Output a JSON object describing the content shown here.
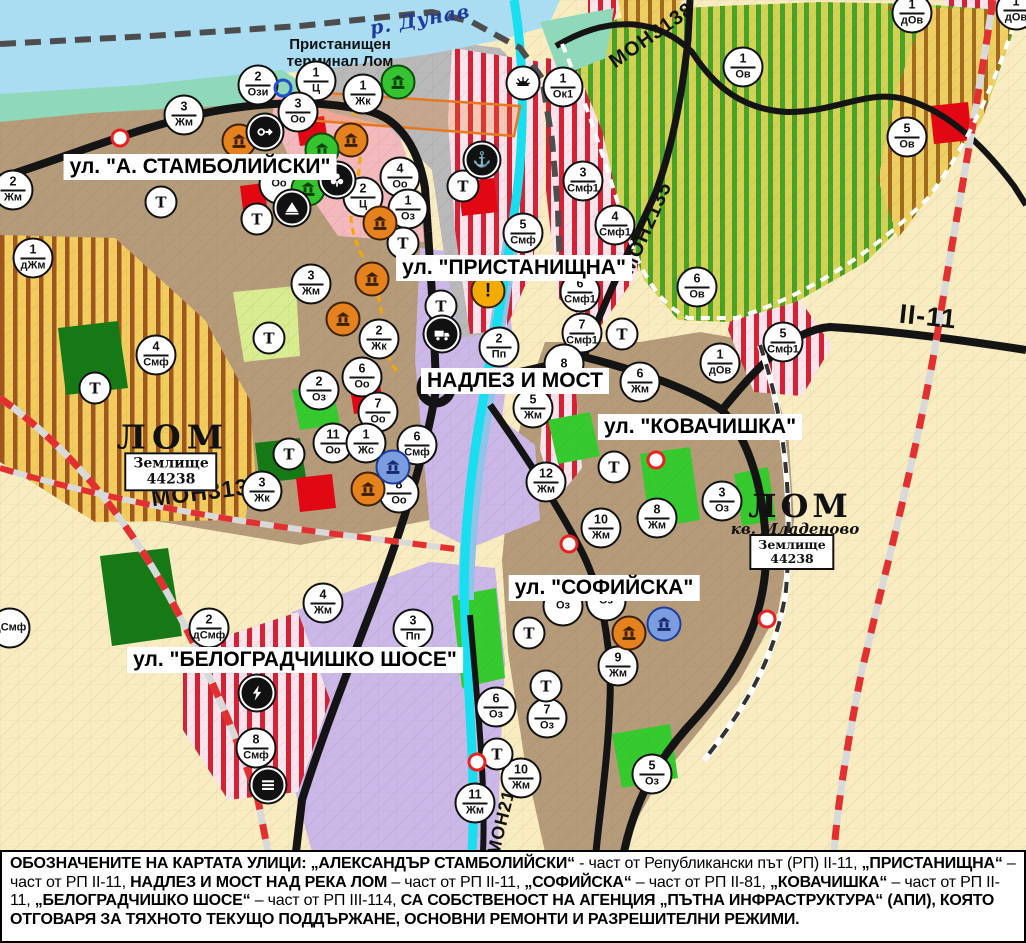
{
  "palette": {
    "water_blue": "#aadcf2",
    "channel_cyan": "#18dff0",
    "river_blue": "#8fc3e8",
    "road_black": "#141414",
    "boundary_red": "#e23030",
    "residential_brown": "#b59b79",
    "industrial_purple": "#cbb8e8",
    "mixed_pink": "#f3b9bd",
    "stripe_red": "#d62135",
    "orchard_green": "#4aa227",
    "farmland_cream": "#f8ecc0",
    "park_green": "#35cb2e",
    "monument_orange": "#e5821e",
    "monument_green": "#35c42f",
    "monument_blue": "#7c9ce0"
  },
  "labels": {
    "river": "р. Дунав",
    "port_line1": "Пристанищен",
    "port_line2": "терминал Лом",
    "city_left": "ЛОМ",
    "city_right": "ЛОМ",
    "district": "кв. Младеново",
    "landzone_line1": "Землище",
    "landzone_number": "44238"
  },
  "street_labels": [
    {
      "text": "ул. \"А. СТАМБОЛИЙСКИ\"",
      "x": 200,
      "y": 167
    },
    {
      "text": "ул. \"ПРИСТАНИЩНА\"",
      "x": 514,
      "y": 268
    },
    {
      "text": "НАДЛЕЗ И МОСТ",
      "x": 515,
      "y": 381
    },
    {
      "text": "ул. \"КОВАЧИШКА\"",
      "x": 700,
      "y": 427
    },
    {
      "text": "ул. \"СОФИЙСКА\"",
      "x": 604,
      "y": 588
    },
    {
      "text": "ул. \"БЕЛОГРАДЧИШКО ШОСЕ\"",
      "x": 295,
      "y": 660
    }
  ],
  "road_labels": [
    {
      "text": "МОН3138",
      "x": 652,
      "y": 36,
      "rot": -35,
      "size": 20
    },
    {
      "text": "МОН2135",
      "x": 647,
      "y": 228,
      "rot": -66,
      "size": 20
    },
    {
      "text": "МОН3139",
      "x": 207,
      "y": 492,
      "rot": -7,
      "size": 23
    },
    {
      "text": "МОН2136",
      "x": 504,
      "y": 812,
      "rot": -76,
      "size": 18
    },
    {
      "text": "II-11",
      "x": 928,
      "y": 317,
      "rot": 6,
      "size": 27
    }
  ],
  "markers": {
    "transport_label": "Т",
    "zone": [
      [
        258,
        85,
        "2",
        "Ози"
      ],
      [
        316,
        81,
        "1",
        "Ц"
      ],
      [
        298,
        112,
        "3",
        "Оо"
      ],
      [
        363,
        94,
        "1",
        "Жк"
      ],
      [
        184,
        115,
        "3",
        "Жм"
      ],
      [
        13,
        190,
        "2",
        "Жм"
      ],
      [
        33,
        258,
        "1",
        "дЖм"
      ],
      [
        279,
        184,
        "",
        "Оо"
      ],
      [
        400,
        177,
        "4",
        "Оо"
      ],
      [
        363,
        197,
        "2",
        "Ц"
      ],
      [
        408,
        209,
        "1",
        "Оз"
      ],
      [
        311,
        284,
        "3",
        "Жм"
      ],
      [
        379,
        339,
        "2",
        "Жк"
      ],
      [
        362,
        377,
        "6",
        "Оо"
      ],
      [
        319,
        390,
        "2",
        "Оз"
      ],
      [
        378,
        412,
        "7",
        "Оо"
      ],
      [
        333,
        443,
        "11",
        "Оо"
      ],
      [
        366,
        443,
        "1",
        "Жс"
      ],
      [
        417,
        445,
        "6",
        "Смф"
      ],
      [
        399,
        493,
        "8",
        "Оо"
      ],
      [
        262,
        491,
        "3",
        "Жк"
      ],
      [
        156,
        355,
        "4",
        "Смф"
      ],
      [
        523,
        233,
        "5",
        "Смф"
      ],
      [
        563,
        87,
        "1",
        "Ок1"
      ],
      [
        583,
        181,
        "3",
        "Смф1"
      ],
      [
        615,
        225,
        "4",
        "Смф1"
      ],
      [
        580,
        292,
        "6",
        "Смф1"
      ],
      [
        582,
        333,
        "7",
        "Смф1"
      ],
      [
        499,
        347,
        "2",
        "Пп"
      ],
      [
        564,
        364,
        "8",
        ""
      ],
      [
        533,
        408,
        "5",
        "Жм"
      ],
      [
        640,
        382,
        "6",
        "Жм"
      ],
      [
        697,
        287,
        "6",
        "Ов"
      ],
      [
        720,
        363,
        "1",
        "дОв"
      ],
      [
        783,
        342,
        "5",
        "Смф1"
      ],
      [
        743,
        67,
        "1",
        "Ов"
      ],
      [
        907,
        137,
        "5",
        "Ов"
      ],
      [
        912,
        13,
        "1",
        "дОв"
      ],
      [
        1016,
        10,
        "1",
        "дОв"
      ],
      [
        546,
        482,
        "12",
        "Жм"
      ],
      [
        601,
        528,
        "10",
        "Жм"
      ],
      [
        657,
        518,
        "8",
        "Жм"
      ],
      [
        722,
        501,
        "3",
        "Оз"
      ],
      [
        563,
        606,
        "",
        "Оз"
      ],
      [
        606,
        601,
        "",
        "Оз"
      ],
      [
        618,
        666,
        "9",
        "Жм"
      ],
      [
        496,
        707,
        "6",
        "Оз"
      ],
      [
        547,
        718,
        "7",
        "Оз"
      ],
      [
        521,
        778,
        "10",
        "Жм"
      ],
      [
        475,
        803,
        "11",
        "Жм"
      ],
      [
        652,
        774,
        "5",
        "Оз"
      ],
      [
        209,
        628,
        "2",
        "дСмф"
      ],
      [
        323,
        603,
        "4",
        "Жм"
      ],
      [
        413,
        629,
        "3",
        "Пп"
      ],
      [
        256,
        748,
        "8",
        "Смф"
      ],
      [
        10,
        628,
        "",
        "дСмф"
      ]
    ],
    "transport": [
      [
        161,
        202
      ],
      [
        257,
        219
      ],
      [
        403,
        243
      ],
      [
        463,
        186
      ],
      [
        269,
        338
      ],
      [
        289,
        454
      ],
      [
        95,
        388
      ],
      [
        441,
        306
      ],
      [
        622,
        334
      ],
      [
        614,
        467
      ],
      [
        529,
        633
      ],
      [
        546,
        686
      ],
      [
        497,
        754
      ]
    ],
    "icons": [
      [
        239,
        141,
        "monument",
        "orange"
      ],
      [
        351,
        140,
        "monument",
        "orange"
      ],
      [
        372,
        279,
        "monument",
        "orange"
      ],
      [
        343,
        319,
        "monument",
        "orange"
      ],
      [
        380,
        223,
        "monument",
        "orange"
      ],
      [
        368,
        489,
        "monument",
        "orange"
      ],
      [
        629,
        633,
        "monument",
        "orange"
      ],
      [
        398,
        82,
        "monument",
        "green"
      ],
      [
        322,
        150,
        "monument",
        "green"
      ],
      [
        308,
        189,
        "monument",
        "green"
      ],
      [
        393,
        467,
        "monument",
        "blue"
      ],
      [
        664,
        624,
        "monument",
        "blue"
      ],
      [
        265,
        132,
        "circle-arrow",
        "black"
      ],
      [
        337,
        180,
        "trefoil",
        "black"
      ],
      [
        292,
        208,
        "tumulus",
        "black"
      ],
      [
        482,
        160,
        "anchor",
        "black"
      ],
      [
        523,
        83,
        "port-sun",
        "white"
      ],
      [
        442,
        334,
        "truck",
        "black"
      ],
      [
        257,
        693,
        "power",
        "black"
      ],
      [
        268,
        785,
        "dashes",
        "black"
      ],
      [
        488,
        291,
        "warning",
        "yellow"
      ]
    ],
    "blue_rings": [
      [
        283,
        88
      ]
    ],
    "red_dots": [
      [
        120,
        138
      ],
      [
        310,
        193
      ],
      [
        656,
        460
      ],
      [
        569,
        544
      ],
      [
        477,
        762
      ],
      [
        767,
        619
      ]
    ]
  },
  "caption": {
    "segments": [
      [
        "ОБОЗНАЧЕНИТЕ НА КАРТАТА УЛИЦИ: „АЛЕКСАНДЪР СТАМБОЛИЙСКИ“",
        1
      ],
      [
        " - част от Републикански път (РП) II-11, ",
        0
      ],
      [
        "„ПРИСТАНИЩНА“",
        1
      ],
      [
        " – част от РП II-11, ",
        0
      ],
      [
        "НАДЛЕЗ И МОСТ НАД РЕКА ЛОМ",
        1
      ],
      [
        " – част от РП II-11, ",
        0
      ],
      [
        "„СОФИЙСКА“",
        1
      ],
      [
        " – част от РП II-81, ",
        0
      ],
      [
        "„КОВАЧИШКА“",
        1
      ],
      [
        " – част от РП II-11, ",
        0
      ],
      [
        "„БЕЛОГРАДЧИШКО ШОСЕ“",
        1
      ],
      [
        " – част от РП III-114, ",
        0
      ],
      [
        "СА СОБСТВЕНОСТ НА АГЕНЦИЯ „ПЪТНА ИНФРАСТРУКТУРА“ (АПИ), КОЯТО ОТГОВАРЯ ЗА ТЯХНОТО ТЕКУЩО ПОДДЪРЖАНЕ, ОСНОВНИ РЕМОНТИ И РАЗРЕШИТЕЛНИ РЕЖИМИ.",
        1
      ]
    ]
  }
}
